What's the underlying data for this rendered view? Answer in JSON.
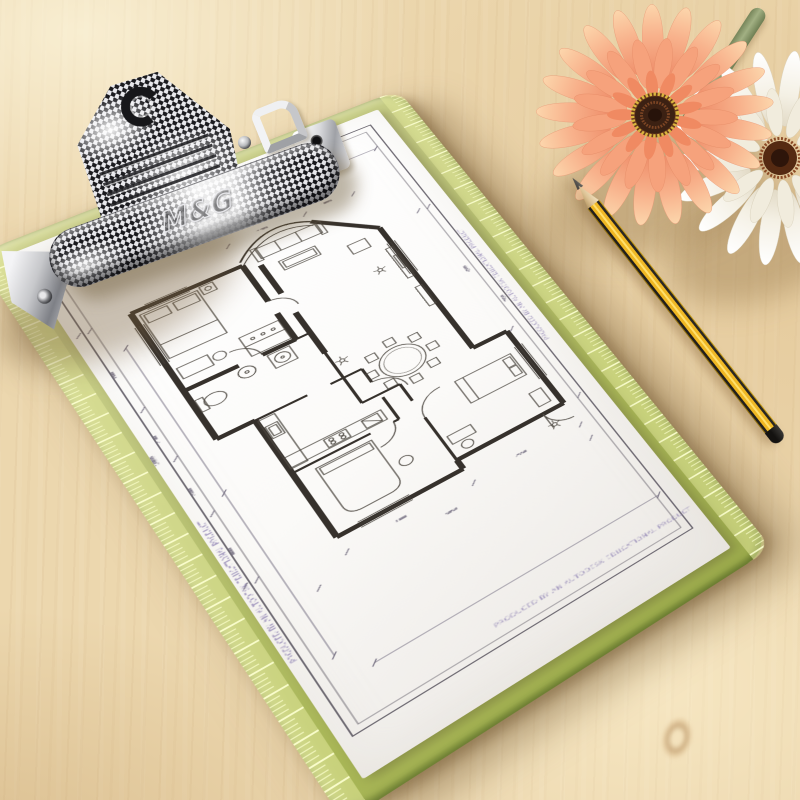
{
  "scene": {
    "type": "photograph",
    "desk": {
      "wood_color": "#ecd7ae",
      "grain_color": "#ab8452"
    },
    "clipboard": {
      "board_color": "#aab858",
      "ruler_tick_color": "#fafdcd",
      "clip": {
        "brand": "M&G",
        "finish": "polished chrome with checkered engraving"
      }
    },
    "paper": {
      "color": "#fbfaf8",
      "content": "apartment floor plan print",
      "watermark": "PRODUCED BY AN AUTODESK EDUCATIONAL PRODUCT",
      "watermark_color": "#8d80b2",
      "wall_color": "#36312c",
      "dims": [
        "3900",
        "2100",
        "2400",
        "3000",
        "10800",
        "3300",
        "2550",
        "5850",
        "2700",
        "1800",
        "4500",
        "7050"
      ]
    },
    "pencil": {
      "style": "yellow and black striped pencil",
      "tip": "sharpened"
    },
    "flowers": {
      "peach": {
        "petal": "#f8b28c",
        "petal_tip": "#fcd6ac",
        "disc": "#3c2113",
        "pollen_ring": "#d9b63e"
      },
      "white": {
        "petal": "#f6f3ea",
        "disc": "#552a12",
        "ring": "#8a4a26"
      },
      "stem_color": "#8a996b"
    }
  }
}
